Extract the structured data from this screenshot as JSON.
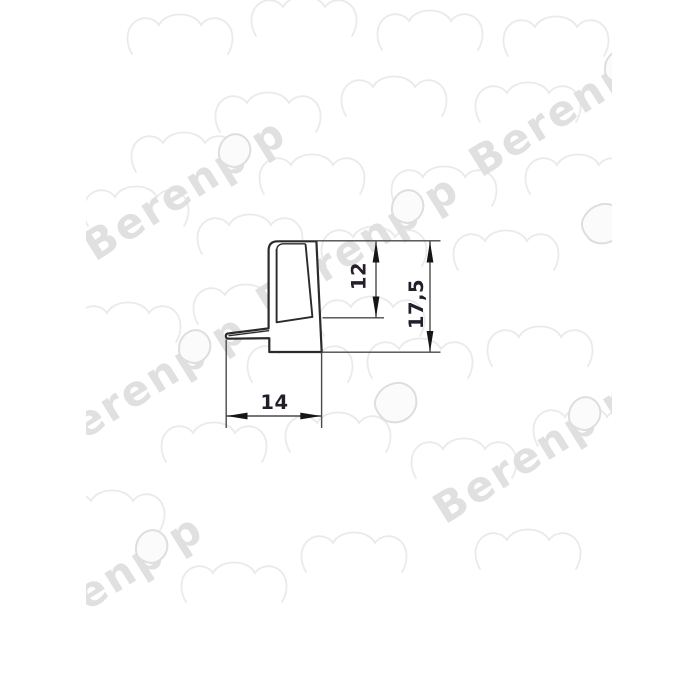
{
  "page": {
    "background_color": "#ffffff",
    "content": "technical cross-section drawing of a sealing profile with dimension annotations"
  },
  "watermark": {
    "brand_text": "Berenpop",
    "text_main": "Berenp",
    "text_tail": "p",
    "angle_deg": -32,
    "font_size": 42,
    "color_text": "#e0e0e0",
    "color_shapes": "#eaeaea",
    "color_drop_stroke": "#dedede",
    "text_instances": [
      [
        95,
        262
      ],
      [
        268,
        318
      ],
      [
        481,
        178
      ],
      [
        55,
        458
      ],
      [
        445,
        525
      ],
      [
        12,
        658
      ]
    ],
    "bear_heads": [
      [
        180,
        30
      ],
      [
        304,
        12
      ],
      [
        430,
        26
      ],
      [
        556,
        32
      ],
      [
        268,
        108
      ],
      [
        394,
        92
      ],
      [
        528,
        98
      ],
      [
        184,
        148
      ],
      [
        312,
        170
      ],
      [
        444,
        182
      ],
      [
        578,
        170
      ],
      [
        136,
        202
      ],
      [
        250,
        230
      ],
      [
        374,
        242
      ],
      [
        506,
        246
      ],
      [
        128,
        318
      ],
      [
        246,
        300
      ],
      [
        372,
        312
      ],
      [
        540,
        342
      ],
      [
        300,
        358
      ],
      [
        420,
        354
      ],
      [
        214,
        438
      ],
      [
        338,
        428
      ],
      [
        464,
        454
      ],
      [
        586,
        422
      ],
      [
        112,
        506
      ],
      [
        234,
        578
      ],
      [
        354,
        548
      ],
      [
        528,
        545
      ]
    ],
    "drops": [
      [
        378,
        387
      ],
      [
        585,
        208
      ]
    ]
  },
  "drawing": {
    "profile_stroke_color": "#2b2b2b",
    "dim_line_color": "#4a4a4a",
    "arrow_color": "#161616",
    "dim_text_color": "#241e2a",
    "dimensions": {
      "width_bottom": {
        "value": "14",
        "orientation": "horizontal"
      },
      "slot_depth": {
        "value": "12",
        "orientation": "vertical"
      },
      "total_height": {
        "value": "17,5",
        "orientation": "vertical"
      }
    }
  }
}
